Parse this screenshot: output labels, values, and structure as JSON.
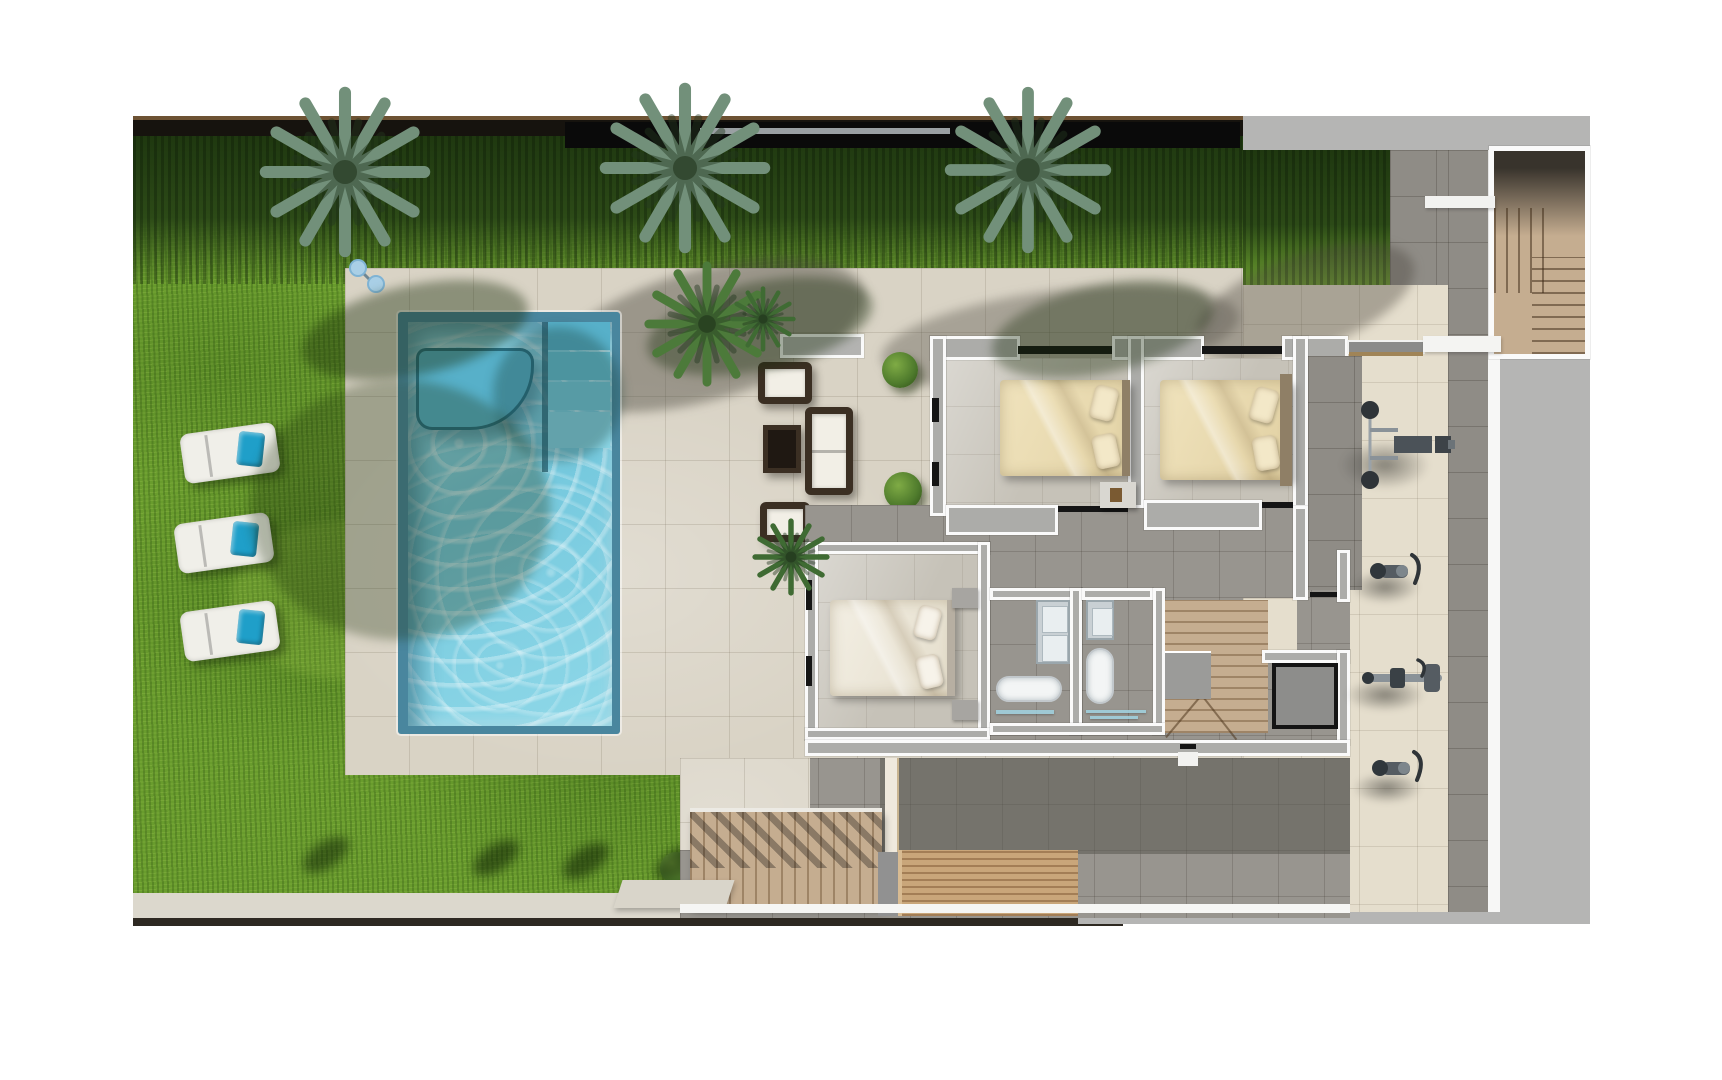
{
  "page": {
    "type": "3d-floor-plan-rendering",
    "view": "top-down",
    "background": "#ffffff"
  },
  "theme": {
    "page": "#ffffff",
    "grass": "#699c2d",
    "hedge": "#2c4a17",
    "deck_tile": "#d9d3c5",
    "gym_tile": "#e5decd",
    "dark_tile": "#98958f",
    "shadow_tile": "#8f8c86",
    "water": "#7fcfe3",
    "water_edge": "#49869e",
    "wall_core": "#acaca9",
    "wall_edge": "#fafafa",
    "wood_stair": "#c5ad90",
    "wood_deck": "#c9a67a",
    "bed_cream": "#ecdeb6",
    "bed_white": "#efeade",
    "towel_blue": "#1f9fc9",
    "rattan": "#3b2f23",
    "cushion": "#f2efe6",
    "metal": "#4b5258",
    "gray_band": "#b5b5b4",
    "fence": "#16130e",
    "bush_green": "#4e7a2c"
  },
  "scene": {
    "garden": {
      "palm_trees_along_top": 3,
      "sun_loungers": 3,
      "lounger_towels": "blue",
      "hedge": "dark clipped hedge along rear boundary",
      "boundary_top": "dark fence wall",
      "boundary_bottom": "light path with dark edge"
    },
    "pool_area": {
      "pool_shape": "rectangular",
      "water_features": [
        "curved submerged bench",
        "corner entry steps"
      ],
      "outdoor_shower": 1,
      "deck": "stone tile sun deck"
    },
    "lounge_terrace": {
      "armchairs": 2,
      "sofa": 1,
      "coffee_table": 1,
      "planter_bench": 1,
      "round_bushes": 2,
      "small_palms": 2
    },
    "house": {
      "bedrooms": [
        {
          "name": "bedroom-1",
          "bed": "double bed with cream bedding and pillows"
        },
        {
          "name": "bedroom-2",
          "bed": "double bed with cream bedding and headboard"
        },
        {
          "name": "bedroom-3",
          "bed": "double bed with white bedding"
        }
      ],
      "bathrooms": [
        {
          "name": "bathroom-1",
          "fixtures": [
            "double vanity",
            "bathtub",
            "glass shelf"
          ]
        },
        {
          "name": "bathroom-2",
          "fixtures": [
            "vanity",
            "bathtub",
            "glass shower"
          ]
        }
      ],
      "circulation": [
        "interior wooden staircase with winders",
        "elevator",
        "hallway"
      ]
    },
    "gym_terrace": {
      "equipment": [
        "bench press station",
        "exercise bike",
        "rowing machine",
        "exercise bike"
      ]
    },
    "exterior_stairs": [
      "upper-right wooden staircase",
      "garden wooden staircase with railing"
    ],
    "wooden_deck": 1
  }
}
